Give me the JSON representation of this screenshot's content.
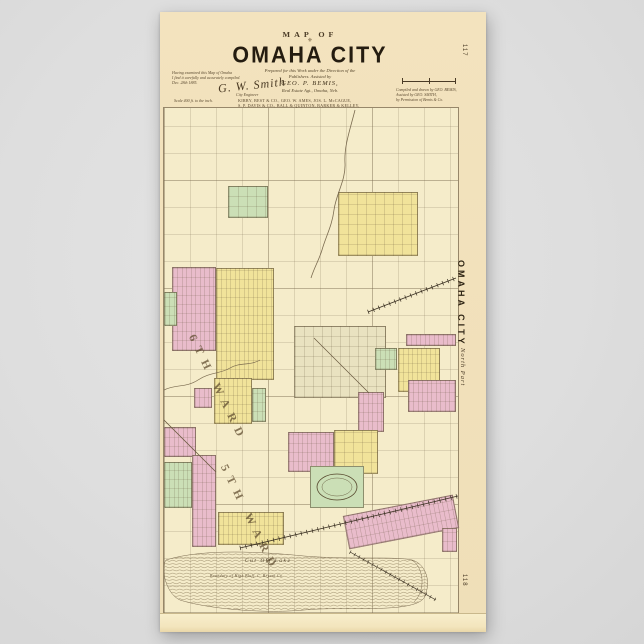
{
  "background_color": "#dedede",
  "palette": {
    "poster_paper": "#f1e0ba",
    "map_paper": "#f5ecca",
    "subdivision_pink": "#e9bccb",
    "subdivision_yellow": "#f1e39a",
    "subdivision_green": "#cbdfb6",
    "line_brown": "#7a6a4f",
    "ink": "#2e2414"
  },
  "poster": {
    "page_number_top": "117",
    "page_number_bottom": "118",
    "title_block": {
      "kicker": "MAP OF",
      "ornament": "⚜",
      "title": "OMAHA CITY",
      "subtitle_line1": "Prepared for this Work under the Direction of the",
      "subtitle_line2": "Publishers. Assisted by",
      "subtitle_name": "GEO. P. BEMIS,",
      "subtitle_line3": "Real Estate Agt., Omaha, Neb.",
      "references": [
        "KIRBY, BEST & CO., GEO. W. AMES, JOS. L. McCAGUE,",
        "S. P. DAVIS & CO., BALL & QUINTON, BARKER & KELLEY,",
        "SEAFORD & HOWES, CLARK & SHIERS, BALLOU BROS.,",
        "PHELAN & CO., Real Estate Agts. and Banks."
      ],
      "left_note_line1": "Having examined this Map of Omaha",
      "left_note_line2": "I find it carefully and accurately compiled.",
      "left_note_line3": "Dec. 28th 1885.",
      "signature": "G. W. Smith",
      "signature_sub": "City Engineer",
      "scale_caption": "Scale 400 ft. to the inch.",
      "right_note_line1": "Compiled and drawn by  GEO. BEMIS,",
      "right_note_line2": "Assisted by  GEO. SMITH,",
      "right_note_line3": "by Permission of Bemis & Co."
    }
  },
  "map": {
    "edge_label_vertical": "OMAHA CITY",
    "edge_label_part": "North Part",
    "ward_labels": [
      "6TH WARD",
      "5TH WARD"
    ],
    "annotations": {
      "lake": "Cut Off Lake",
      "bluff_note": "Boundary of High Bluff, C. Bryant Co."
    },
    "regions": [
      {
        "name": "cemetery-block",
        "x": 64,
        "y": 78,
        "w": 40,
        "h": 32,
        "color": "#cbdfb6",
        "grid": "blocks"
      },
      {
        "name": "subdivision-yellow-north",
        "x": 174,
        "y": 84,
        "w": 80,
        "h": 64,
        "color": "#f1e39a",
        "grid": "blocks"
      },
      {
        "name": "subdivision-pink-west",
        "x": 8,
        "y": 159,
        "w": 44,
        "h": 84,
        "color": "#e9bccb",
        "grid": "lots"
      },
      {
        "name": "subdivision-yellow-central",
        "x": 52,
        "y": 160,
        "w": 58,
        "h": 112,
        "color": "#f1e39a",
        "grid": "lots"
      },
      {
        "name": "strip-green-far-left",
        "x": 0,
        "y": 184,
        "w": 13,
        "h": 34,
        "color": "#cbdfb6",
        "grid": "lots"
      },
      {
        "name": "subdivision-central-dense",
        "x": 130,
        "y": 218,
        "w": 92,
        "h": 72,
        "color": "#e9e2c0",
        "grid": "blocks"
      },
      {
        "name": "strip-pink-east",
        "x": 242,
        "y": 226,
        "w": 50,
        "h": 12,
        "color": "#e9bccb",
        "grid": "lots"
      },
      {
        "name": "block-green-east",
        "x": 211,
        "y": 240,
        "w": 22,
        "h": 22,
        "color": "#cbdfb6",
        "grid": "lots"
      },
      {
        "name": "subdivision-yellow-east",
        "x": 234,
        "y": 240,
        "w": 42,
        "h": 44,
        "color": "#f1e39a",
        "grid": "lots"
      },
      {
        "name": "subdivision-pink-east2",
        "x": 244,
        "y": 272,
        "w": 48,
        "h": 32,
        "color": "#e9bccb",
        "grid": "lots"
      },
      {
        "name": "block-pink-central",
        "x": 194,
        "y": 284,
        "w": 26,
        "h": 40,
        "color": "#e9bccb",
        "grid": "lots"
      },
      {
        "name": "subdivision-yellow-ward6",
        "x": 50,
        "y": 270,
        "w": 38,
        "h": 46,
        "color": "#f1e39a",
        "grid": "lots"
      },
      {
        "name": "strip-green-ward6",
        "x": 88,
        "y": 280,
        "w": 14,
        "h": 34,
        "color": "#cbdfb6",
        "grid": "lots"
      },
      {
        "name": "block-pink-ward6",
        "x": 30,
        "y": 280,
        "w": 18,
        "h": 20,
        "color": "#e9bccb",
        "grid": "lots"
      },
      {
        "name": "block-pink-sw",
        "x": 0,
        "y": 319,
        "w": 32,
        "h": 30,
        "color": "#e9bccb",
        "grid": "lots"
      },
      {
        "name": "strip-green-sw",
        "x": 0,
        "y": 354,
        "w": 28,
        "h": 46,
        "color": "#cbdfb6",
        "grid": "lots"
      },
      {
        "name": "strip-pink-sw",
        "x": 28,
        "y": 347,
        "w": 24,
        "h": 92,
        "color": "#e9bccb",
        "grid": "lots"
      },
      {
        "name": "block-pink-south",
        "x": 124,
        "y": 324,
        "w": 46,
        "h": 40,
        "color": "#e9bccb",
        "grid": "lots"
      },
      {
        "name": "block-yellow-south",
        "x": 170,
        "y": 322,
        "w": 44,
        "h": 44,
        "color": "#f1e39a",
        "grid": "blocks"
      },
      {
        "name": "driving-park",
        "x": 146,
        "y": 358,
        "w": 54,
        "h": 42,
        "color": "#cbdfb6"
      },
      {
        "name": "strip-pink-railroad",
        "x": 181,
        "y": 397,
        "w": 112,
        "h": 34,
        "color": "#e9bccb",
        "grid": "lots",
        "rotate": -11
      },
      {
        "name": "block-yellow-sw",
        "x": 54,
        "y": 404,
        "w": 66,
        "h": 33,
        "color": "#f1e39a",
        "grid": "lots"
      },
      {
        "name": "block-pink-se",
        "x": 278,
        "y": 420,
        "w": 15,
        "h": 24,
        "color": "#e9bccb",
        "grid": "lots"
      }
    ]
  }
}
